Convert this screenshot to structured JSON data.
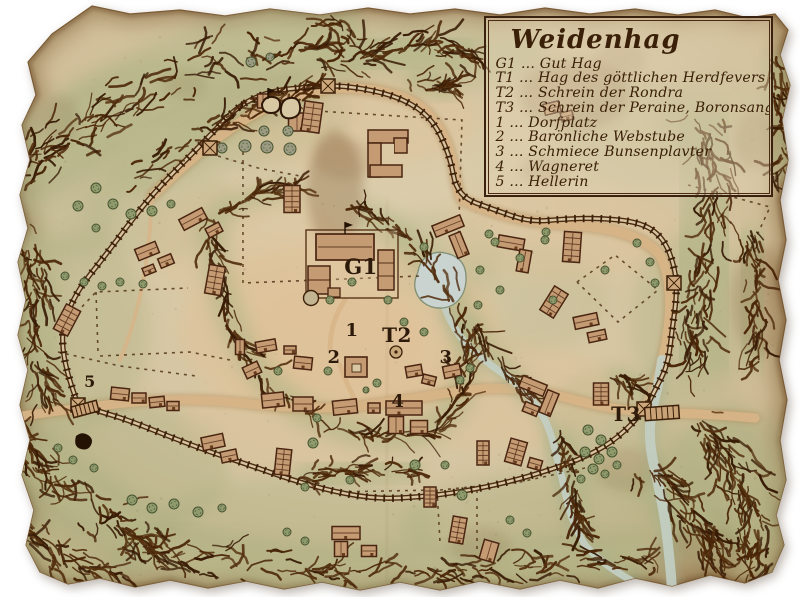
{
  "colors": {
    "paper": "#d6c6a3",
    "paper_edge": "#9a7b52",
    "ink": "#3a1d08",
    "label_ink": "#2e1a0a",
    "green_wash": "#a9ae80",
    "road": "#d7b487",
    "plaza": "#e3c29b",
    "building_fill": "#c49b72",
    "building_stroke": "#4a2511",
    "tree_fill": "#8f9a6d",
    "tree_grey": "#9a9b82",
    "pond": "#cad5d3",
    "stream": "#c3cfc4",
    "legend_border": "#3b2110"
  },
  "legend": {
    "title": "Weidenhag",
    "separator": "...",
    "entries": [
      {
        "key": "G1",
        "label": "Gut Hag"
      },
      {
        "key": "T1",
        "label": "Hag des göttlichen Herdfevers"
      },
      {
        "key": "T2",
        "label": "Schrein der Rondra"
      },
      {
        "key": "T3",
        "label": "Schrein der Peraine, Boronsanger"
      },
      {
        "key": "1",
        "label": "Dorfplatz"
      },
      {
        "key": "2",
        "label": "Barönliche Webstube"
      },
      {
        "key": "3",
        "label": "Schmiece Bunsenplavter"
      },
      {
        "key": "4",
        "label": "Wagneret"
      },
      {
        "key": "5",
        "label": "Hellerin"
      }
    ]
  },
  "map": {
    "labels": [
      {
        "id": "g1",
        "text": "G1",
        "x": 361,
        "y": 274,
        "size": 21
      },
      {
        "id": "1",
        "text": "1",
        "x": 352,
        "y": 336,
        "size": 18
      },
      {
        "id": "t2",
        "text": "T2",
        "x": 397,
        "y": 342,
        "size": 20
      },
      {
        "id": "2",
        "text": "2",
        "x": 334,
        "y": 363,
        "size": 18
      },
      {
        "id": "3",
        "text": "3",
        "x": 446,
        "y": 363,
        "size": 18
      },
      {
        "id": "4",
        "text": "4",
        "x": 398,
        "y": 407,
        "size": 18
      },
      {
        "id": "5",
        "text": "5",
        "x": 90,
        "y": 387,
        "size": 16
      },
      {
        "id": "t3",
        "text": "T3",
        "x": 626,
        "y": 421,
        "size": 20
      }
    ]
  }
}
